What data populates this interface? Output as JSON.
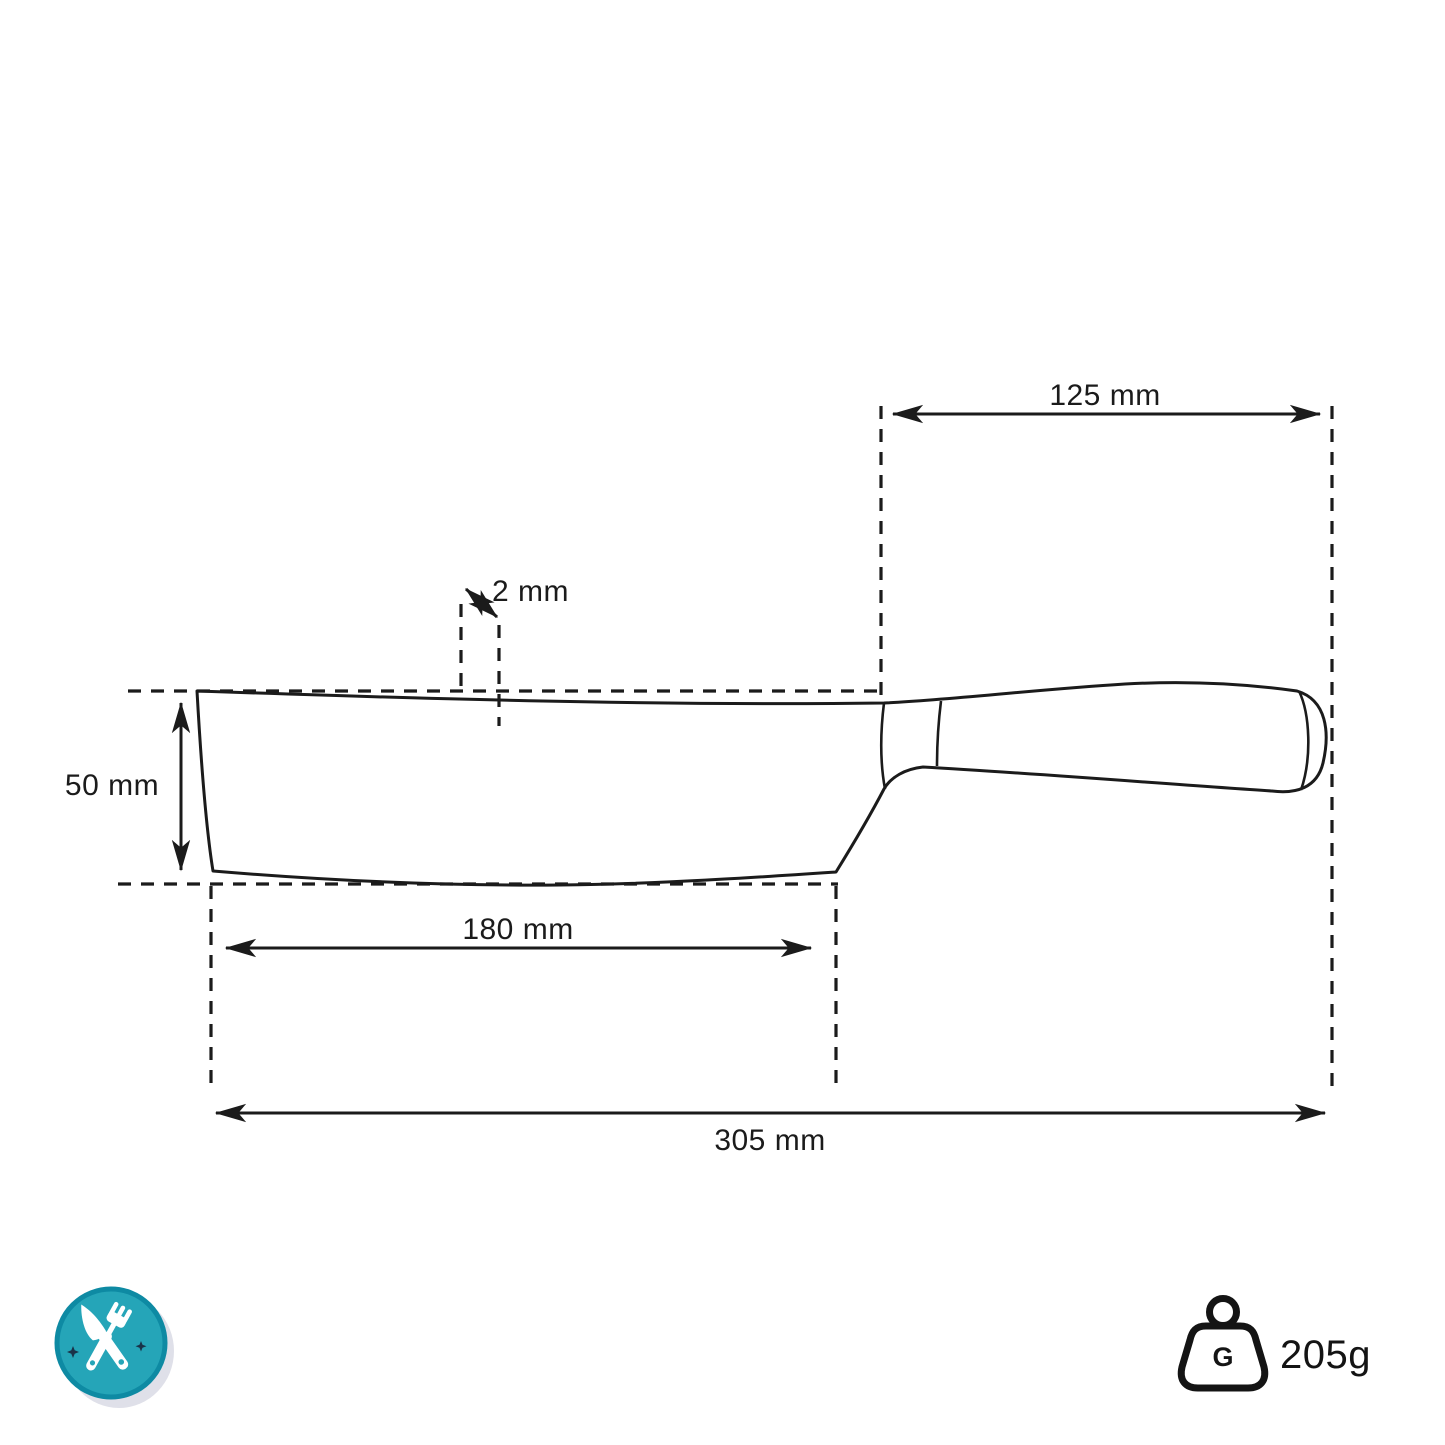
{
  "diagram": {
    "subject": "knife-dimension-drawing",
    "dimensions": {
      "handle_length": {
        "label": "125 mm",
        "value_mm": 125
      },
      "spine_thickness": {
        "label": "2 mm",
        "value_mm": 2
      },
      "blade_height": {
        "label": "50 mm",
        "value_mm": 50
      },
      "blade_length": {
        "label": "180 mm",
        "value_mm": 180
      },
      "total_length": {
        "label": "305 mm",
        "value_mm": 305
      }
    },
    "weight": {
      "badge_letter": "G",
      "label": "205g",
      "value_g": 205
    },
    "icons": {
      "badge": "crossed-knife-and-fork-badge",
      "weight": "weight-block-with-ring"
    },
    "colors": {
      "line": "#1b1b1b",
      "background": "#ffffff",
      "badge_teal": "#25a5b8",
      "badge_teal_dark": "#0e8aa3",
      "badge_star": "#1a3349",
      "badge_shadow": "#c9ccdb"
    }
  }
}
